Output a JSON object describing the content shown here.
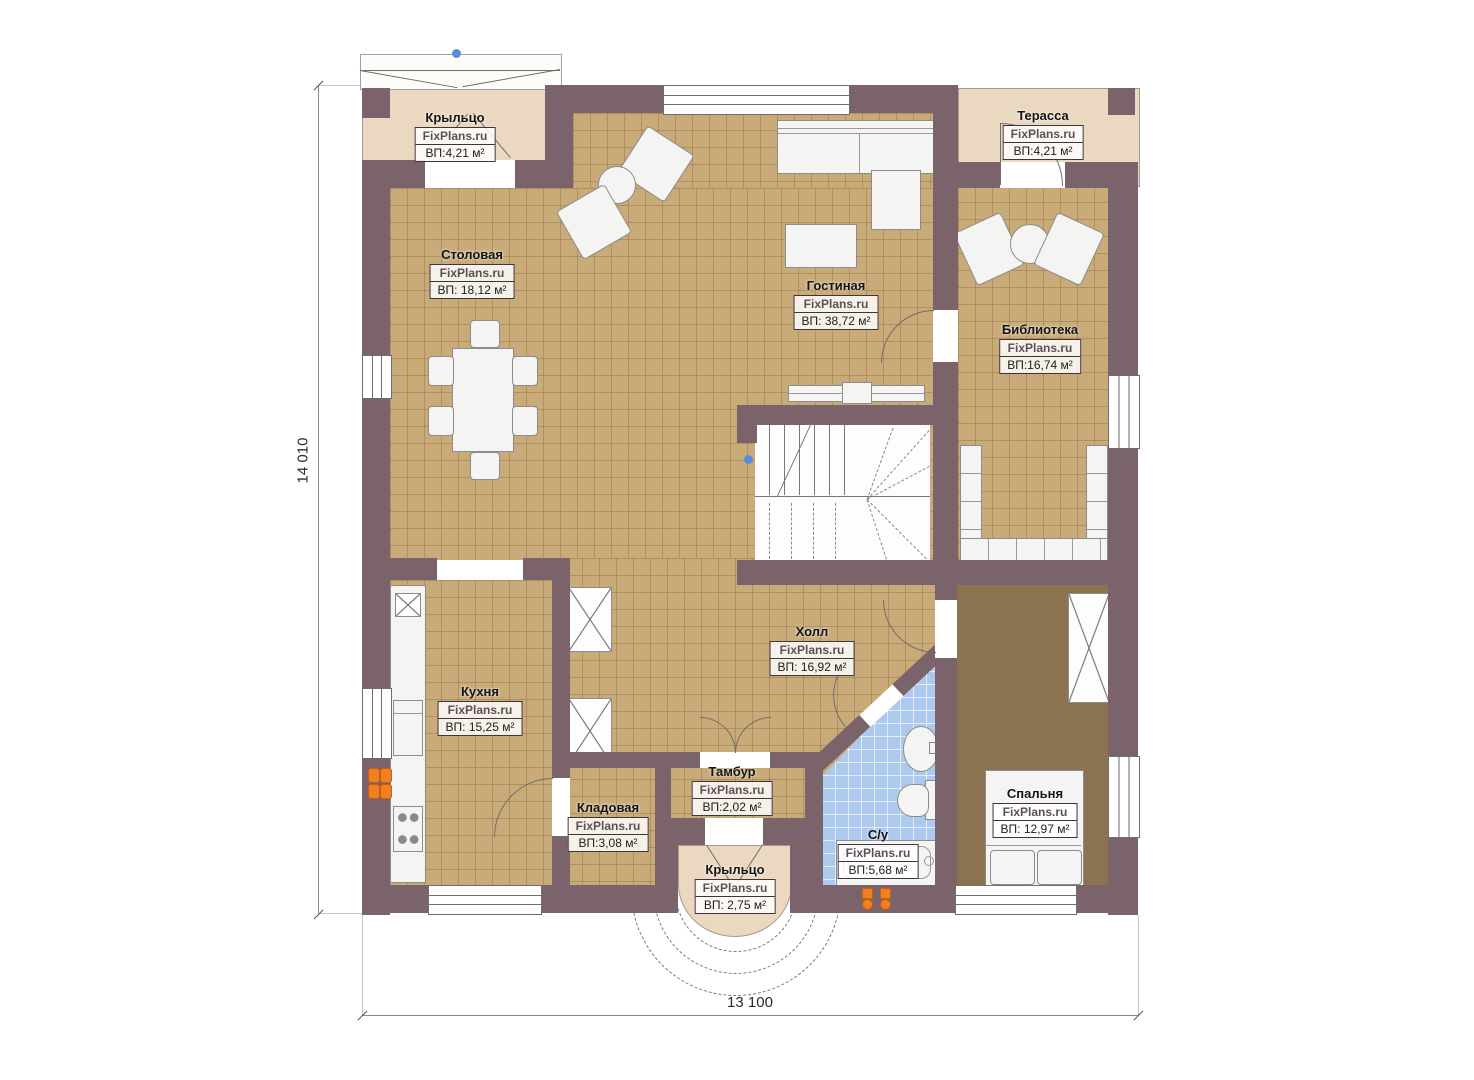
{
  "watermark": "FixPlans.ru",
  "dimensions": {
    "height": "14 010",
    "width": "13 100"
  },
  "rooms": [
    {
      "id": "porch-top",
      "name": "Крыльцо",
      "area": "ВП:4,21 м²"
    },
    {
      "id": "terrace",
      "name": "Терасса",
      "area": "ВП:4,21 м²"
    },
    {
      "id": "dining",
      "name": "Столовая",
      "area": "ВП: 18,12 м²"
    },
    {
      "id": "living",
      "name": "Гостиная",
      "area": "ВП: 38,72 м²"
    },
    {
      "id": "library",
      "name": "Библиотека",
      "area": "ВП:16,74 м²"
    },
    {
      "id": "kitchen",
      "name": "Кухня",
      "area": "ВП: 15,25 м²"
    },
    {
      "id": "hall",
      "name": "Холл",
      "area": "ВП: 16,92 м²"
    },
    {
      "id": "pantry",
      "name": "Кладовая",
      "area": "ВП:3,08 м²"
    },
    {
      "id": "vestibule",
      "name": "Тамбур",
      "area": "ВП:2,02 м²"
    },
    {
      "id": "bathroom",
      "name": "С/у",
      "area": "ВП:5,68 м²"
    },
    {
      "id": "bedroom",
      "name": "Спальня",
      "area": "ВП: 12,97 м²"
    },
    {
      "id": "porch-bottom",
      "name": "Крыльцо",
      "area": "ВП: 2,75 м²"
    }
  ],
  "colors": {
    "wall": "#7a636a",
    "tile_floor": "#c9ab79",
    "porch_floor": "#ead9c0",
    "bathroom_floor": "#adc9ee",
    "bedroom_floor": "#8b7351",
    "marker_orange": "#f08021",
    "marker_blue": "#5b8dd6"
  }
}
